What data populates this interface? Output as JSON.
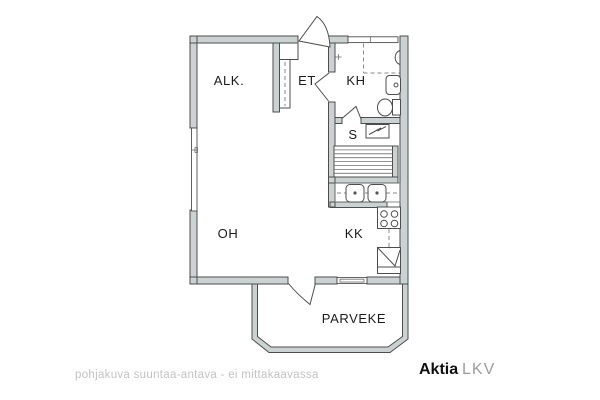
{
  "rooms": {
    "alk": "ALK.",
    "et": "ET",
    "kh": "KH",
    "s": "S",
    "oh": "OH",
    "kk": "KK",
    "parveke": "PARVEKE"
  },
  "footer": {
    "disclaimer": "pohjakuva suuntaa-antava - ei mittakaavassa"
  },
  "brand": {
    "name": "Aktia",
    "suffix": "LKV"
  },
  "colors": {
    "wall_fill": "#cbd2d2",
    "outline": "#4d4d4d",
    "label_text": "#1c1c1c",
    "disclaimer_text": "#c3c3c3",
    "brand_name": "#111111",
    "brand_suffix": "#9c9c9c",
    "background": "#ffffff"
  },
  "fixtures": [
    "entrance-door",
    "wardrobe",
    "shower-area",
    "shower-mixer",
    "washbasin",
    "toilet",
    "sauna-stove",
    "sauna-benches",
    "double-sink",
    "stove",
    "refrigerator",
    "balcony-door",
    "window"
  ]
}
